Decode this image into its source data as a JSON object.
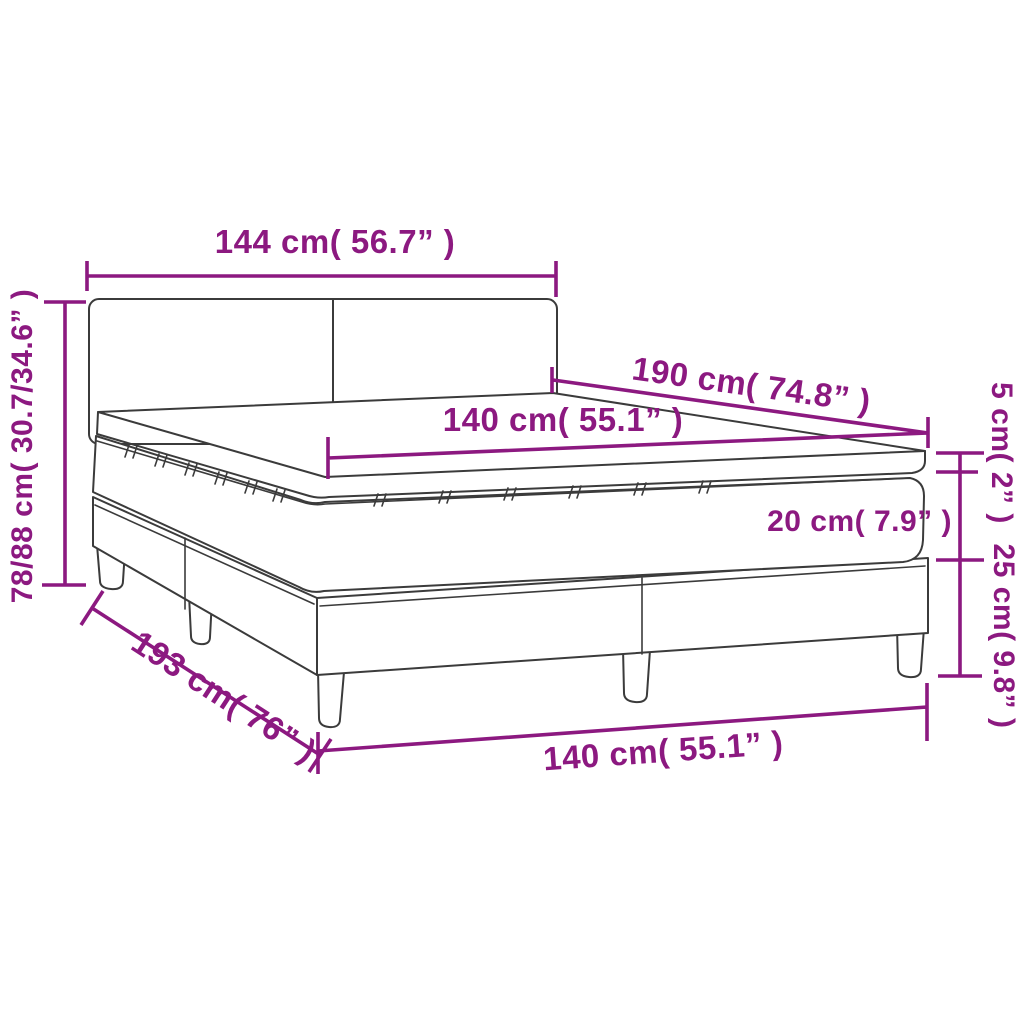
{
  "diagram": {
    "type": "product-dimension-diagram",
    "subject": "box spring bed with headboard, mattress and topper",
    "colors": {
      "accent": "#8C1980",
      "line_art": "#3b3b3b",
      "background": "#ffffff"
    },
    "parts": [
      "headboard",
      "mattress topper",
      "mattress",
      "box spring base",
      "legs"
    ],
    "dimensions": {
      "headboard_width": {
        "label": "144 cm( 56.7” )",
        "cm": "144",
        "inches": "56.7"
      },
      "total_height": {
        "label": "78/88 cm( 30.7/34.6” )",
        "cm": "78/88",
        "inches": "30.7/34.6"
      },
      "mattress_length": {
        "label": "190 cm( 74.8” )",
        "cm": "190",
        "inches": "74.8"
      },
      "mattress_width": {
        "label": "140 cm( 55.1” )",
        "cm": "140",
        "inches": "55.1"
      },
      "topper_height": {
        "label": "5 cm( 2” )",
        "cm": "5",
        "inches": "2"
      },
      "mattress_height": {
        "label": "20 cm( 7.9” )",
        "cm": "20",
        "inches": "7.9"
      },
      "base_height": {
        "label": "25 cm( 9.8” )",
        "cm": "25",
        "inches": "9.8"
      },
      "bed_length": {
        "label": "193 cm( 76” )",
        "cm": "193",
        "inches": "76"
      },
      "base_width": {
        "label": "140 cm( 55.1” )",
        "cm": "140",
        "inches": "55.1"
      }
    }
  }
}
